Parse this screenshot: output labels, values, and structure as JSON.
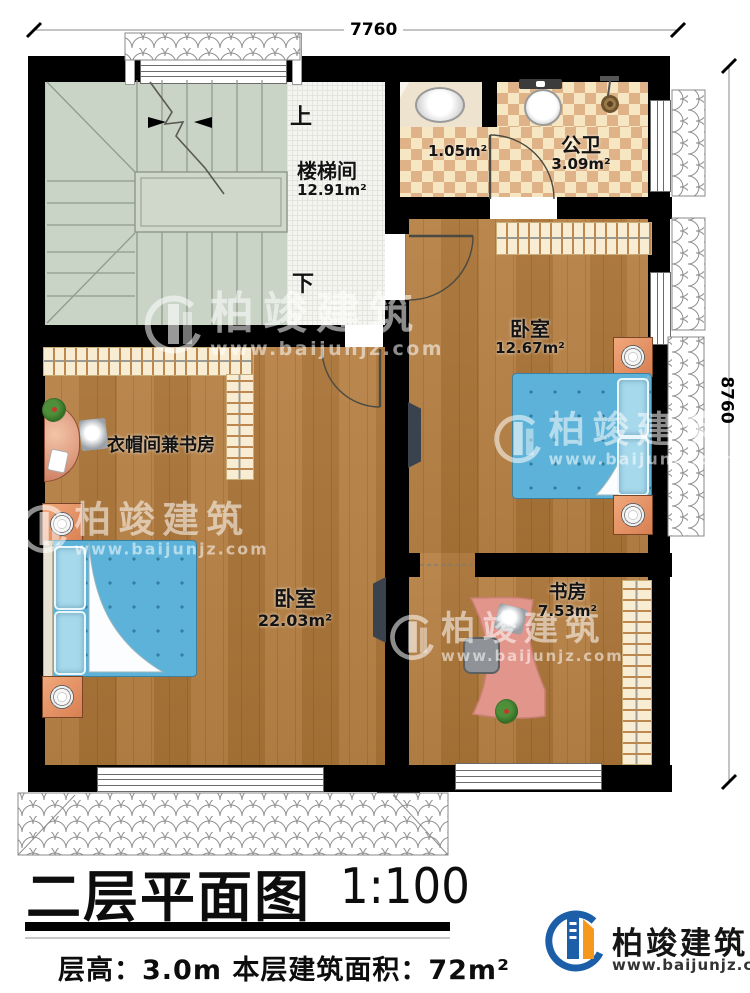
{
  "dimensions": {
    "top": "7760",
    "right": "8760"
  },
  "stairwell": {
    "name": "楼梯间",
    "area": "12.91m²",
    "up": "上",
    "down": "下"
  },
  "bathroom": {
    "name": "公卫",
    "area": "3.09m²",
    "vestibule_area": "1.05m²"
  },
  "bedroom_right": {
    "name": "卧室",
    "area": "12.67m²"
  },
  "bedroom_left": {
    "name": "卧室",
    "area": "22.03m²"
  },
  "cloakroom": {
    "name": "衣帽间兼书房"
  },
  "study": {
    "name": "书房",
    "area": "7.53m²"
  },
  "watermark": {
    "brand": "柏竣建筑",
    "url": "www.baijunjz.com"
  },
  "title_block": {
    "title": "二层平面图",
    "scale": "1:100",
    "floor_info": "层高：3.0m  本层建筑面积：72m²"
  },
  "logo": {
    "brand": "柏竣建筑",
    "url": "www.baijunjz.com"
  },
  "colors": {
    "wall": "#000000",
    "wood": "#b07b40",
    "stair": "#c9d3c6",
    "checker": "#dfb287",
    "bed": "#5cb2d8",
    "accent_blue": "#1c5fa8",
    "accent_orange": "#f6981d"
  }
}
